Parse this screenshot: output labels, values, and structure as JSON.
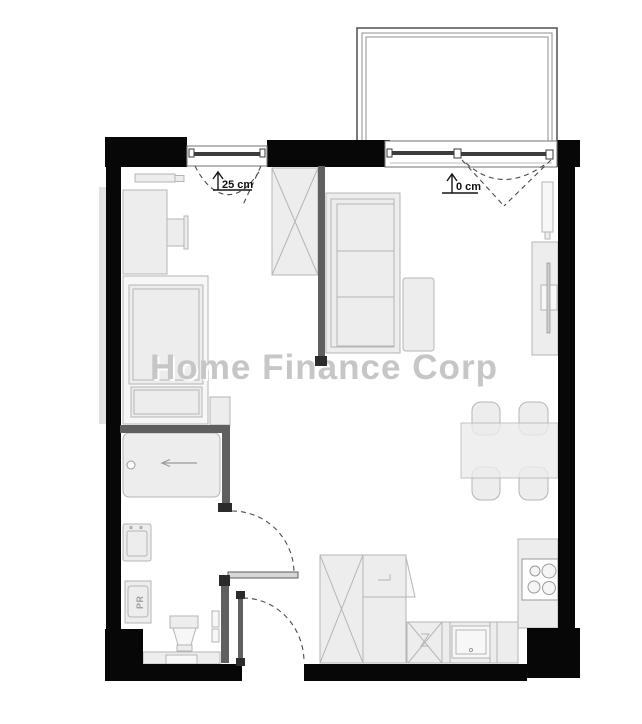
{
  "watermark": {
    "text": "Home Finance Corp"
  },
  "annotations": {
    "left_window_offset": "25 cm",
    "right_window_offset": "0 cm"
  },
  "labels": {
    "washer": "PR"
  },
  "colors": {
    "wall": "#070707",
    "partition": "#5f5f5f",
    "furniture_fill": "#ededed",
    "furniture_stroke": "#b5b5b5",
    "watermark": "#c6c6c6",
    "floor": "#ffffff"
  }
}
